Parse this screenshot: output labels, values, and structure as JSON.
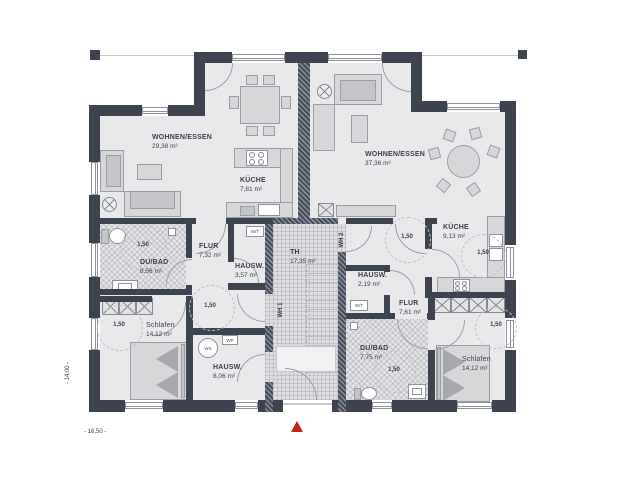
{
  "rooms": {
    "wohnen1": {
      "name": "WOHNEN/ESSEN",
      "area": "29,38 m²"
    },
    "kueche1": {
      "name": "KÜCHE",
      "area": "7,81 m²"
    },
    "wohnen2": {
      "name": "WOHNEN/ESSEN",
      "area": "37,36 m²"
    },
    "kueche2": {
      "name": "KÜCHE",
      "area": "9,13 m²"
    },
    "dubad1": {
      "name": "DU/BAD",
      "area": "8,56 m²"
    },
    "flur1": {
      "name": "FLUR",
      "area": "7,32 m²"
    },
    "hausw1": {
      "name": "HAUSW.",
      "area": "3,57 m²"
    },
    "th": {
      "name": "TH",
      "area": "17,35 m²"
    },
    "hausw2": {
      "name": "HAUSW.",
      "area": "2,19 m²"
    },
    "flur2": {
      "name": "FLUR",
      "area": "7,61 m²"
    },
    "dubad2": {
      "name": "DU/BAD",
      "area": "7,75 m²"
    },
    "schlafen1": {
      "name": "Schlafen",
      "area": "14,12 m²"
    },
    "schlafen2": {
      "name": "Schlafen",
      "area": "14,12 m²"
    },
    "hausw3": {
      "name": "HAUSW.",
      "area": "8,06 m²"
    }
  },
  "units": {
    "wh1": "WH 1",
    "wh2": "WH 2"
  },
  "clearance": {
    "label": "1,50"
  },
  "equipment": {
    "wt": "W/T",
    "ws": "WS",
    "wp": "WP",
    "msa": "MSA"
  },
  "dimensions": {
    "width": "- 16,50 -",
    "depth": "- 14,00 -"
  },
  "colors": {
    "wall": "#3d4450",
    "floor": "#e9e9ec",
    "entrance_marker": "#c42318"
  }
}
